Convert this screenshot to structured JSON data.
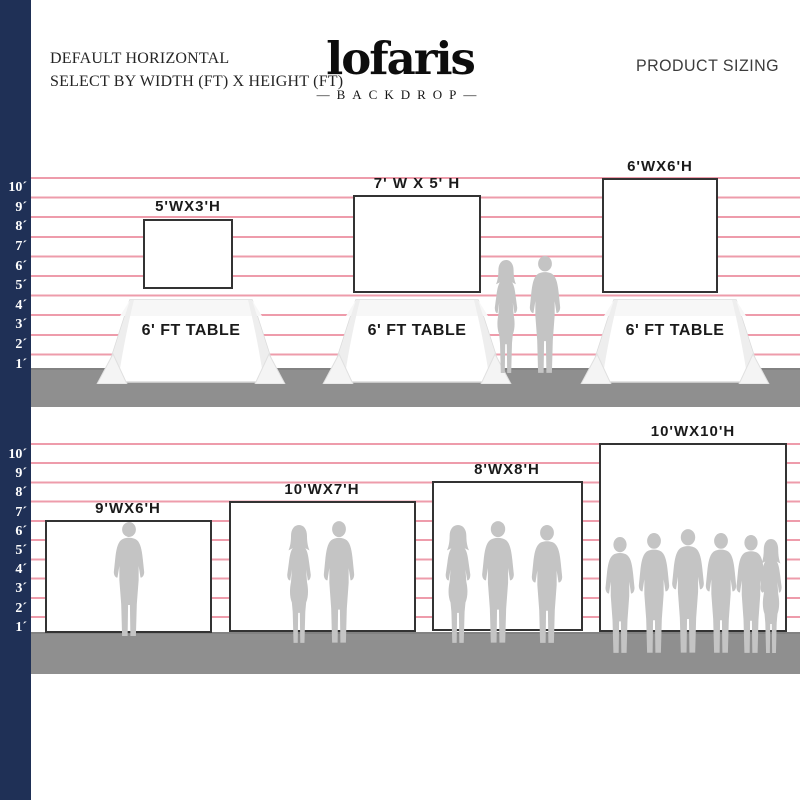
{
  "title_block": {
    "line1": "DEFAULT HORIZONTAL",
    "line2": "SELECT BY WIDTH (FT) X HEIGHT (FT)"
  },
  "logo": {
    "name": "lofaris",
    "tagline": "—BACKDROP—"
  },
  "product_sizing_label": "PRODUCT SIZING",
  "ruler": {
    "labels": [
      "10´",
      "9´",
      "8´",
      "7´",
      "6´",
      "5´",
      "4´",
      "3´",
      "2´",
      "1´"
    ]
  },
  "sections": {
    "top": {
      "backdrops": [
        {
          "size": "5'WX3'H"
        },
        {
          "size": "7' W X 5' H"
        },
        {
          "size": "6'WX6'H"
        }
      ],
      "tables": [
        {
          "label": "6' FT TABLE"
        },
        {
          "label": "6' FT TABLE"
        },
        {
          "label": "6' FT TABLE"
        }
      ],
      "figures": [
        {
          "icon": "standing-couple-silhouette"
        }
      ]
    },
    "bottom": {
      "backdrops": [
        {
          "size": "9'WX6'H",
          "figure": "single-man-silhouette"
        },
        {
          "size": "10'WX7'H",
          "figure": "standing-couple-silhouette"
        },
        {
          "size": "8'WX8'H",
          "figure": "three-people-silhouette"
        },
        {
          "size": "10'WX10'H",
          "figure": "six-people-group-silhouette"
        }
      ]
    }
  },
  "colors": {
    "navy_bar": "#1f3056",
    "grid_line_pink": "#ee9cab",
    "floor_gray": "#8f8f8f",
    "silhouette_gray": "#c4c4c4",
    "backdrop_border": "#333333"
  }
}
